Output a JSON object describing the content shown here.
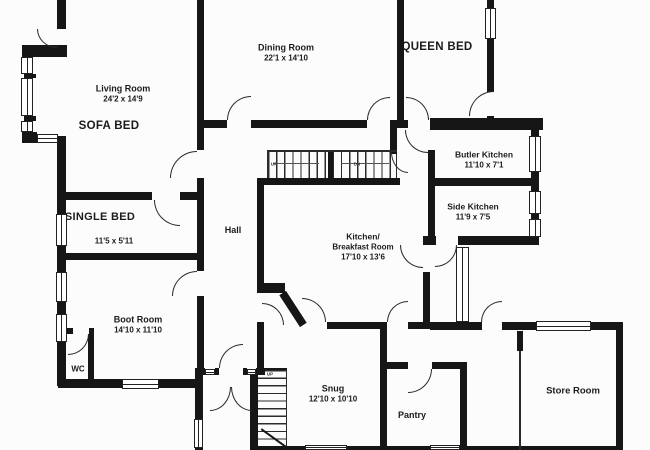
{
  "plan": {
    "rooms": [
      {
        "name": "Living Room",
        "dims": "24'2 x 14'9"
      },
      {
        "name": "SOFA BED"
      },
      {
        "name": "Dining Room",
        "dims": "22'1 x 14'10"
      },
      {
        "name": "QUEEN BED"
      },
      {
        "name": "Butler Kitchen",
        "dims": "11'10 x 7'1"
      },
      {
        "name": "Side Kitchen",
        "dims": "11'9 x 7'5"
      },
      {
        "name": "SINGLE BED",
        "dims": "11'5 x 5'11"
      },
      {
        "name": "Hall"
      },
      {
        "name": "Kitchen/",
        "name2": "Breakfast Room",
        "dims": "17'10 x 13'6"
      },
      {
        "name": "Boot Room",
        "dims": "14'10 x 11'10"
      },
      {
        "name": "WC"
      },
      {
        "name": "Snug",
        "dims": "12'10 x 10'10"
      },
      {
        "name": "Pantry"
      },
      {
        "name": "Store Room"
      }
    ],
    "stairs": {
      "up": "UP",
      "down": "DN"
    },
    "colors": {
      "wall": "#161616",
      "floor": "#ffffff",
      "text": "#1b1b1b"
    }
  }
}
